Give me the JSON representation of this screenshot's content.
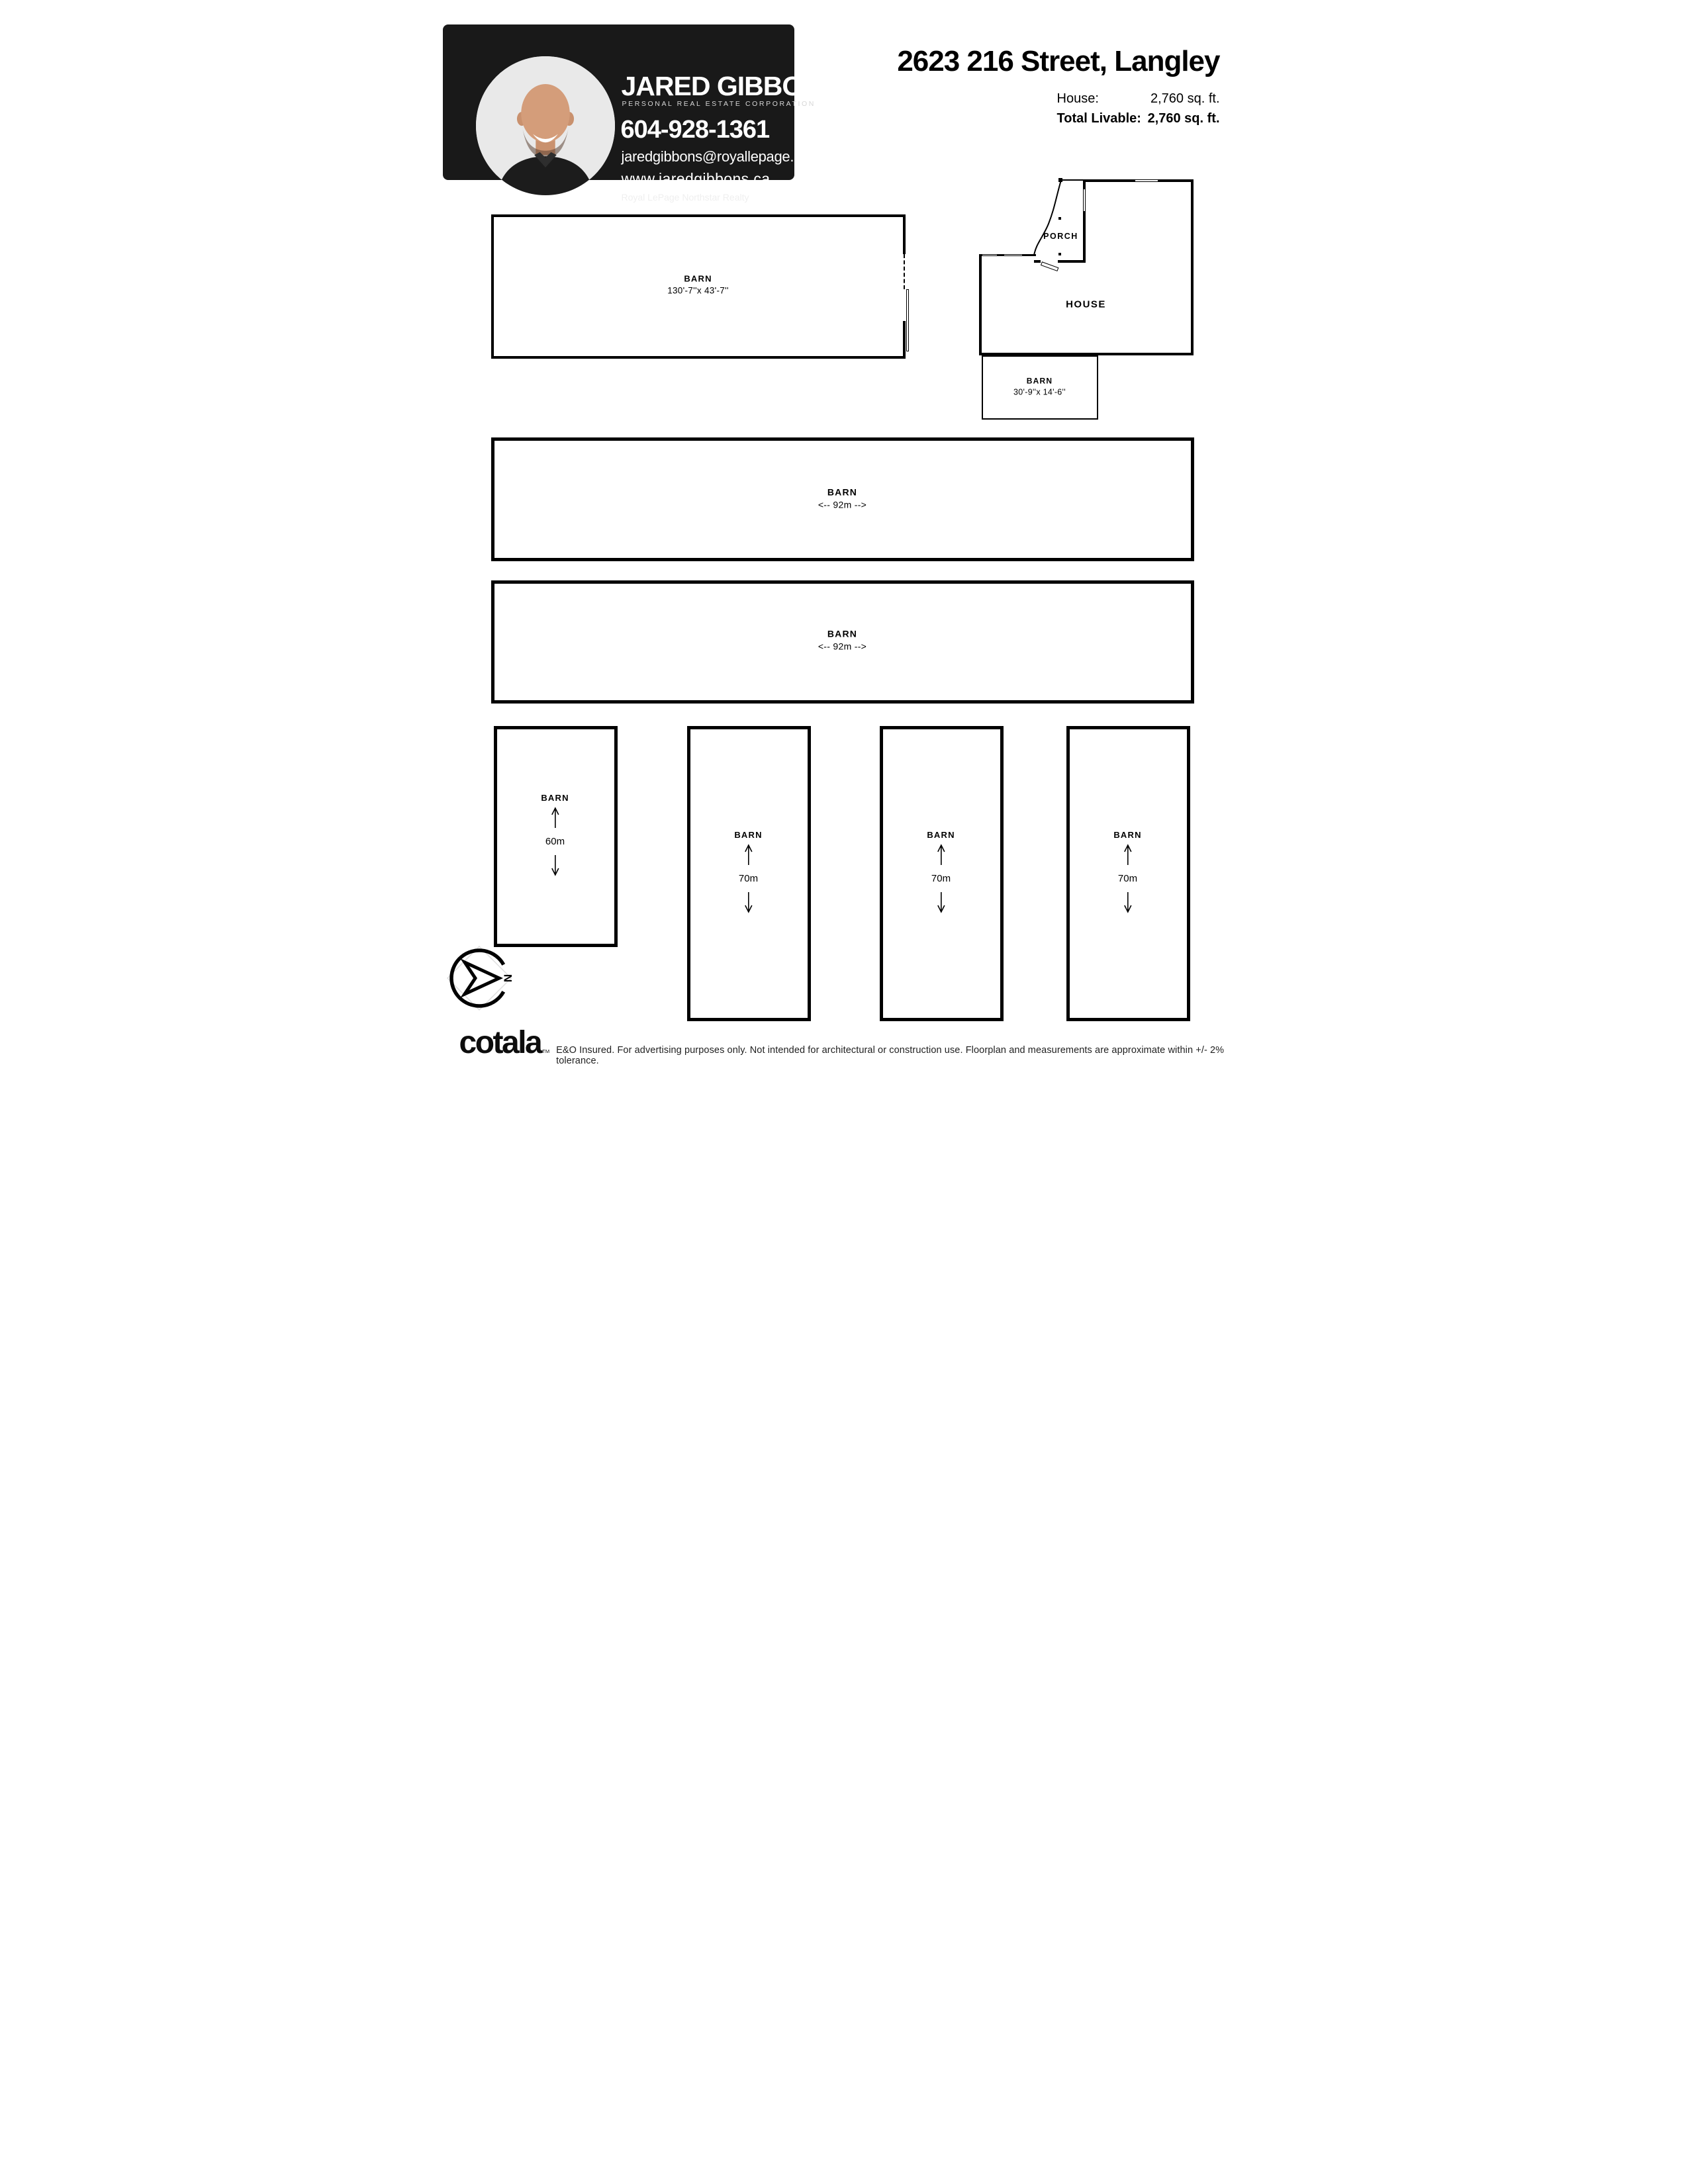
{
  "agent": {
    "name": "JARED GIBBONS",
    "subtitle": "PERSONAL REAL ESTATE CORPORATION",
    "phone": "604-928-1361",
    "email": "jaredgibbons@royallepage.ca",
    "website": "www.jaredgibbons.ca",
    "brokerage": "Royal LePage Northstar Realty"
  },
  "header": {
    "address": "2623 216 Street, Langley",
    "stats": [
      {
        "label": "House:",
        "value": "2,760 sq. ft."
      },
      {
        "label": "Total Livable:",
        "value": "2,760 sq. ft."
      }
    ]
  },
  "rooms": {
    "barn_large": {
      "label": "BARN",
      "dims": "130'-7''x 43'-7''"
    },
    "porch": {
      "label": "PORCH"
    },
    "house": {
      "label": "HOUSE"
    },
    "barn_small": {
      "label": "BARN",
      "dims": "30'-9''x 14'-6''"
    },
    "barn_92_a": {
      "label": "BARN",
      "dims": "<-- 92m -->"
    },
    "barn_92_b": {
      "label": "BARN",
      "dims": "<-- 92m -->"
    },
    "barn_60": {
      "label": "BARN",
      "length": "60m"
    },
    "barn_70_a": {
      "label": "BARN",
      "length": "70m"
    },
    "barn_70_b": {
      "label": "BARN",
      "length": "70m"
    },
    "barn_70_c": {
      "label": "BARN",
      "length": "70m"
    }
  },
  "compass": {
    "north": "N"
  },
  "footer": {
    "logo": "cotala",
    "tm": "TM",
    "disclaimer": "E&O Insured. For advertising purposes only. Not intended for architectural or construction use. Floorplan and measurements are approximate within +/- 2% tolerance."
  },
  "colors": {
    "wall": "#000000",
    "card_bg": "#191919",
    "paper": "#ffffff"
  }
}
